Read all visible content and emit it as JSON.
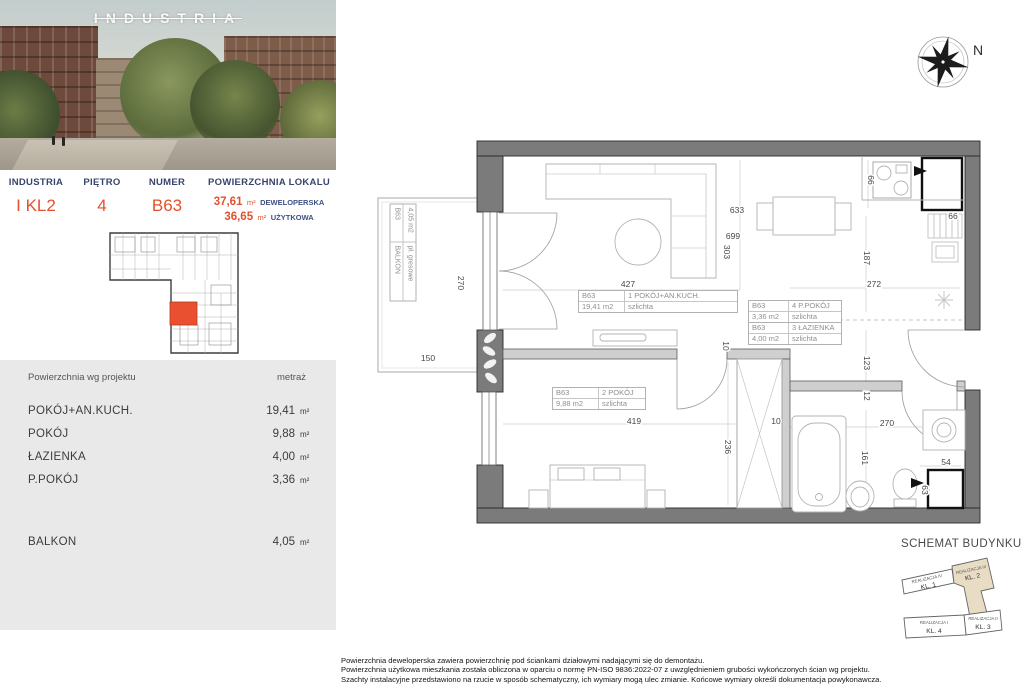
{
  "photo": {
    "logo": "INDUSTRIA"
  },
  "header": {
    "cols": [
      {
        "label": "INDUSTRIA",
        "value": "I KL2"
      },
      {
        "label": "PIĘTRO",
        "value": "4"
      },
      {
        "label": "NUMER",
        "value": "B63"
      }
    ],
    "area_label": "POWIERZCHNIA LOKALU",
    "areas": [
      {
        "value": "37,61",
        "unit": "m²",
        "kind": "DEWELOPERSKA"
      },
      {
        "value": "36,65",
        "unit": "m²",
        "kind": "UŻYTKOWA"
      }
    ]
  },
  "table": {
    "header": {
      "left": "Powierzchnia wg projektu",
      "right": "metraż"
    },
    "rows": [
      {
        "name": "POKÓJ+AN.KUCH.",
        "value": "19,41",
        "unit": "m²"
      },
      {
        "name": "POKÓJ",
        "value": "9,88",
        "unit": "m²"
      },
      {
        "name": "ŁAZIENKA",
        "value": "4,00",
        "unit": "m²"
      },
      {
        "name": "P.POKÓJ",
        "value": "3,36",
        "unit": "m²"
      }
    ],
    "balcony_row": {
      "name": "BALKON",
      "value": "4,05",
      "unit": "m²"
    }
  },
  "plan": {
    "compass_label": "N",
    "labels": {
      "living": {
        "id": "B63",
        "name": "1 POKÓJ+AN.KUCH.",
        "area": "19,41 m2",
        "floor": "szlichta"
      },
      "bedroom": {
        "id": "B63",
        "name": "2 POKÓJ",
        "area": "9,88 m2",
        "floor": "szlichta"
      },
      "bath": {
        "id": "B63",
        "name": "3 ŁAZIENKA",
        "area": "4,00 m2",
        "floor": "szlichta"
      },
      "hall": {
        "id": "B63",
        "name": "4 P.POKÓJ",
        "area": "3,36 m2",
        "floor": "szlichta"
      },
      "balcony": {
        "id": "B63",
        "name": "BALKON",
        "area": "4,05 m2",
        "floor": "pł. gresowe"
      }
    },
    "dims": {
      "balcony_h": "270",
      "balcony_w": "150",
      "living_w": "427",
      "top_a": "633",
      "top_b": "699",
      "top_c": "303",
      "kitchen_a": "66",
      "shaft_top": "66",
      "kitchen_b": "187",
      "kitchen_w": "272",
      "wall_a": "10",
      "hall_a": "123",
      "hall_b": "12",
      "bath_w": "270",
      "bath_h": "161",
      "shaft_b_w": "54",
      "shaft_b_h": "63",
      "bedroom_h": "236",
      "bedroom_w": "419",
      "wall_b": "10"
    }
  },
  "schematic": {
    "title": "SCHEMAT BUDYNKU",
    "segments": [
      {
        "line1": "REALIZACJA IV",
        "line2": "KL. 1",
        "highlighted": false
      },
      {
        "line1": "REALIZACJA III",
        "line2": "KL. 2",
        "highlighted": true
      },
      {
        "line1": "REALIZACJA II",
        "line2": "KL. 3",
        "highlighted": false
      },
      {
        "line1": "REALIZACJA I",
        "line2": "KL. 4",
        "highlighted": false
      }
    ]
  },
  "footnotes": [
    "Powierzchnia deweloperska zawiera powierzchnię pod ściankami działowymi nadającymi się do demontażu.",
    "Powierzchnia użytkowa mieszkania została obliczona w oparciu o normę PN-ISO 9836:2022-07 z uwzględnieniem grubości wykończonych ścian wg projektu.",
    "Szachty instalacyjne przedstawiono na rzucie w sposób schematyczny, ich wymiary mogą ulec zmianie. Końcowe wymiary określi dokumentacja powykonawcza."
  ],
  "colors": {
    "accent": "#e2512d",
    "navy": "#39456b",
    "wall": "#7b7b7b",
    "highlight": "#e9dcc4"
  }
}
